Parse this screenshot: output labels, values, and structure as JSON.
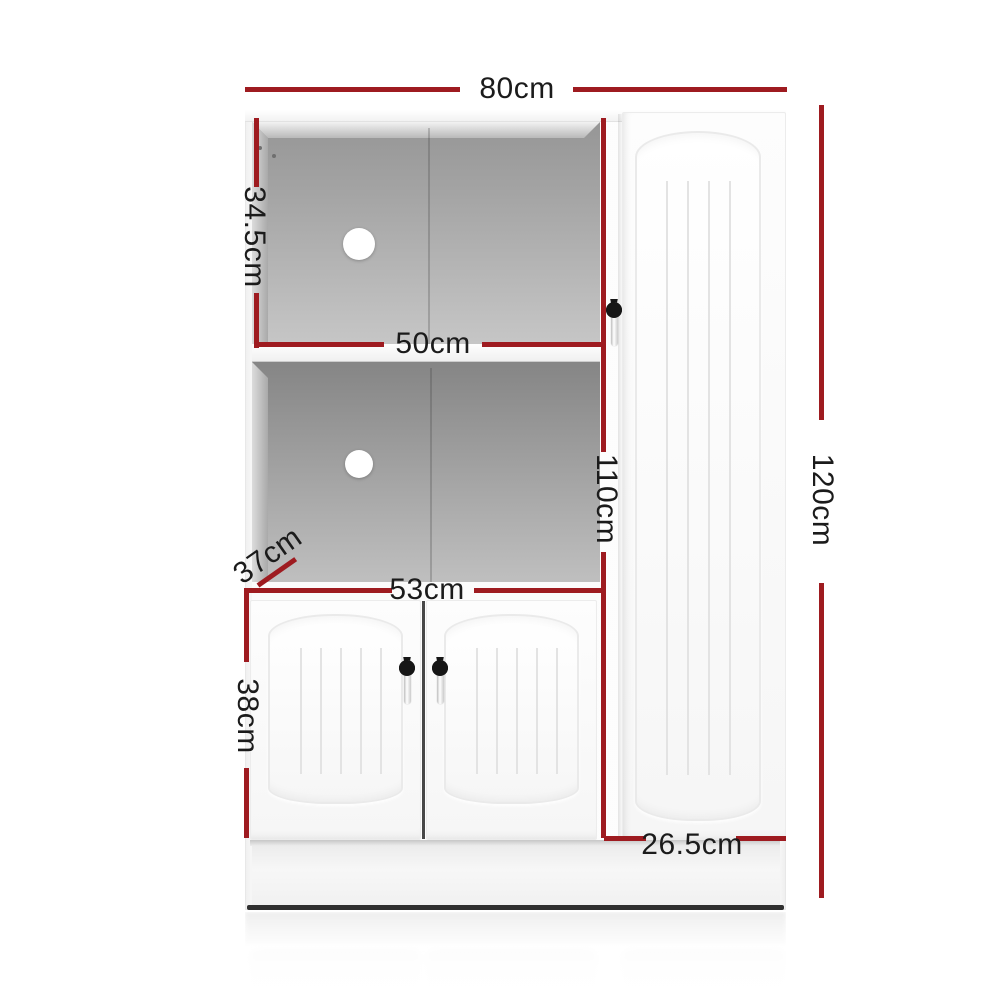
{
  "diagram": {
    "type": "product-dimension-diagram",
    "subject": "White buffet sideboard storage cabinet with open shelves and doors",
    "accent_color": "#9e1b20",
    "label_color": "#1b1b1b"
  },
  "labels": {
    "overall_width": "80cm",
    "top_shelf_height": "34.5cm",
    "shelf_width": "50cm",
    "depth": "37cm",
    "lower_doors_width": "53cm",
    "lower_doors_height": "38cm",
    "left_section_height": "110cm",
    "overall_height": "120cm",
    "right_door_width": "26.5cm"
  }
}
